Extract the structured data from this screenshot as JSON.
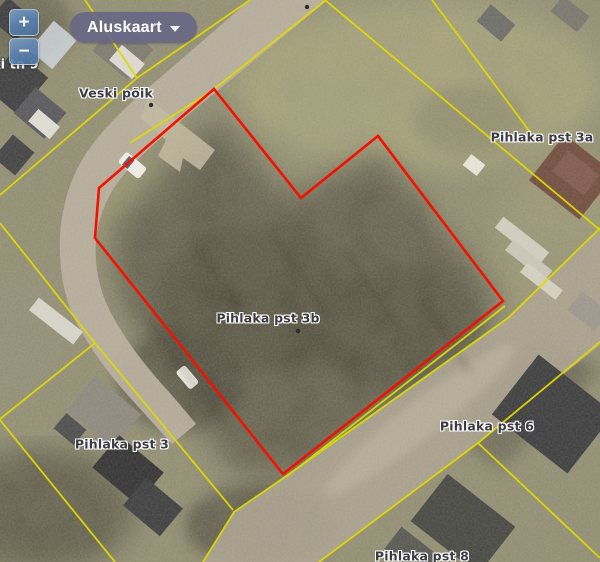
{
  "controls": {
    "zoom_in_label": "+",
    "zoom_out_label": "−",
    "basemap_button_label": "Aluskaart"
  },
  "map_labels": {
    "street_partial": "ki tn 9",
    "street_veski": "Veski põik",
    "parcel_3a": "Pihlaka pst 3a",
    "parcel_3b": "Pihlaka pst 3b",
    "parcel_3": "Pihlaka pst 3",
    "parcel_6": "Pihlaka pst 6",
    "parcel_8": "Pihlaka pst 8"
  },
  "selection": {
    "selected_parcel": "Pihlaka pst 3b",
    "outline_color": "#f51000"
  },
  "cadastral": {
    "boundary_color": "#e0da00"
  }
}
